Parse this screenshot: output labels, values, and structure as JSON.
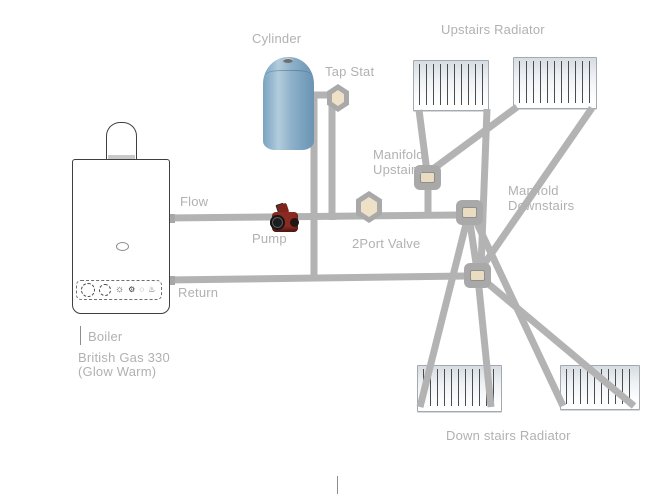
{
  "diagram": {
    "labels": {
      "cylinder": "Cylinder",
      "tap_stat": "Tap Stat",
      "upstairs_radiator": "Upstairs Radiator",
      "manifold_upstairs_line1": "Manifold",
      "manifold_upstairs_line2": "Upstairs",
      "manifold_downstairs_line1": "Manifold",
      "manifold_downstairs_line2": "Downstairs",
      "flow": "Flow",
      "pump": "Pump",
      "two_port_valve": "2Port Valve",
      "return": "Return",
      "boiler": "Boiler",
      "boiler_model_line1": "British Gas 330",
      "boiler_model_line2": "(Glow Warm)",
      "downstairs_radiator": "Down stairs Radiator"
    },
    "icons": {
      "tap_stat_valve": "hexagon-valve",
      "two_port_valve": "hexagon-valve",
      "pump": "red-circulating-pump",
      "manifold_upstairs_node": "square-junction",
      "flow_junction_node": "square-junction",
      "manifold_downstairs_node": "square-junction",
      "boiler_flue": "dome",
      "boiler_panel_knobs": [
        "dial-circle",
        "dial-circle",
        "sun",
        "gear",
        "dotted-circle",
        "hot-springs"
      ]
    },
    "colors": {
      "pipe": "#b3b3b3",
      "label_text": "#b1b1b1",
      "valve_fill": "#eee1c8",
      "valve_border": "#a9a9a9",
      "node_fill": "#eadcc0",
      "cylinder_blue": "#8fb2ca",
      "pump_red": "#8b2a20",
      "radiator_fin": "#4a4d50",
      "boiler_outline": "#3f3f3f"
    }
  }
}
